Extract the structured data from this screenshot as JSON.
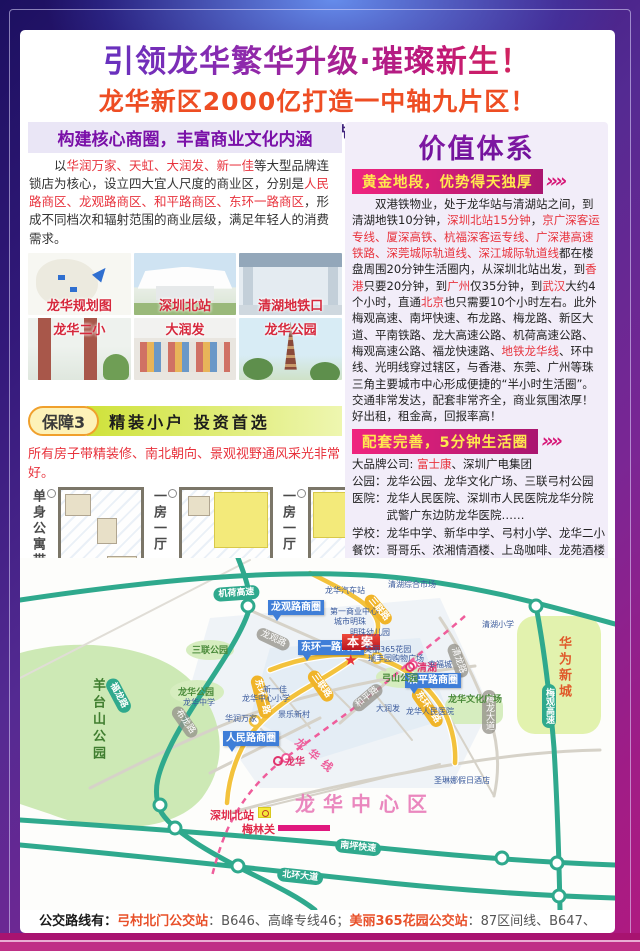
{
  "header": {
    "title": "引领龙华繁华升级·璀璨新生！",
    "subtitle": "龙华新区2000亿打造一中轴九片区！",
    "tagline": "10分钟地铁口醇熟区域、先买先收益、掌控财富人生！"
  },
  "left": {
    "section_title": "构建核心商圈，丰富商业文化内涵",
    "intro_runs": [
      {
        "t": "以",
        "c": ""
      },
      {
        "t": "华润万家、天虹、大润发、新一佳",
        "c": "red"
      },
      {
        "t": "等大型品牌连锁店为核心，设立四大宜人尺度的商业区，分别是",
        "c": ""
      },
      {
        "t": "人民路商区、龙观路商区、和平路商区、东环一路商区",
        "c": "red"
      },
      {
        "t": "，形成不同档次和辐射范围的商业层级，满足年轻人的消费需求。",
        "c": ""
      }
    ],
    "photos": [
      {
        "label": "龙华规划图"
      },
      {
        "label": "深圳北站"
      },
      {
        "label": "清湖地铁口"
      },
      {
        "label": "龙华二小"
      },
      {
        "label": "大润发"
      },
      {
        "label": "龙华公园"
      }
    ],
    "guarantee_badge": "保障3",
    "guarantee_title": "精装小户 投资首选",
    "guarantee_note": "所有房子带精装修、南北朝向、景观视野通风采光非常好。",
    "plans": [
      {
        "label": "单身公寓带精装修"
      },
      {
        "label": "一房一厅"
      },
      {
        "label": "一房一厅"
      }
    ]
  },
  "right": {
    "main_title": "价值体系",
    "chevrons": "»»",
    "banner1": "黄金地段，优势得天独厚",
    "para1_runs": [
      {
        "t": "双港铁物业，处于龙华站与清湖站之间，到清湖地铁10分钟，",
        "c": ""
      },
      {
        "t": "深圳北站15分钟",
        "c": "red"
      },
      {
        "t": "，",
        "c": ""
      },
      {
        "t": "京广深客运专线、厦深高铁、杭福深客运专线、广深港高速铁路、深莞城际轨道线、深江城际轨道线",
        "c": "red"
      },
      {
        "t": "都在楼盘周围20分钟生活圈内，从深圳北站出发，到",
        "c": ""
      },
      {
        "t": "香港",
        "c": "red"
      },
      {
        "t": "只要20分钟，到",
        "c": ""
      },
      {
        "t": "广州",
        "c": "red"
      },
      {
        "t": "仅35分钟，到",
        "c": ""
      },
      {
        "t": "武汉",
        "c": "red"
      },
      {
        "t": "大约4个小时，直通",
        "c": ""
      },
      {
        "t": "北京",
        "c": "red"
      },
      {
        "t": "也只需要10个小时左右。此外梅观高速、南坪快速、布龙路、梅龙路、新区大道、平南铁路、龙大高速公路、机荷高速公路、梅观高速公路、福龙快速路、",
        "c": ""
      },
      {
        "t": "地铁龙华线",
        "c": "red"
      },
      {
        "t": "、环中线、光明线穿过辖区，与香港、东莞、广州等珠三角主要城市中心形成便捷的“半小时生活圈”。交通非常发达，配套非常齐全，商业氛围浓厚！好出租，租金高，回报率高！",
        "c": ""
      }
    ],
    "banner2": "配套完善，5分钟生活圈",
    "fac_company_label": "大品牌公司: ",
    "fac_company_red": "富士康",
    "fac_company_rest": "、深圳广电集团",
    "fac_lines": [
      "公园：龙华公园、龙华文化广场、三联弓村公园",
      "医院：龙华人民医院、深圳市人民医院龙华分院",
      "　　　武警广东边防龙华医院……",
      "学校：龙华中学、新华中学、弓村小学、龙华二小",
      "餐饮：哥哥乐、浓湘情酒楼、上岛咖啡、龙苑酒楼",
      "购物：大润发、华润万家、佳华商场、新一佳商场",
      "酒店：圣琳娜假日酒店、轩莱斯酒店、新宝城酒店",
      "银行：四大银行,平安银行、中信银行、东亚银行"
    ],
    "banner3": "靠山天然氧吧·风水宝地",
    "para3_runs": [
      {
        "t": "项目地处龙华新区旧改第一村(弓村)，青山近城，紧邻占地4万平方米的",
        "c": ""
      },
      {
        "t": "原生态弓山公园，在风水学上形成“明堂之地”",
        "c": "red"
      },
      {
        "t": "，有着百年历史的弓山公园，孕育了多种珍贵树种以及鸟类、昆虫等生物，",
        "c": ""
      },
      {
        "t": "是原生态、纯天然的氧吧。",
        "c": "red"
      }
    ]
  },
  "map": {
    "labels": [
      {
        "t": "机荷高速",
        "x": 193,
        "y": 30,
        "c": "pill-teal",
        "r": -4
      },
      {
        "t": "福龙路",
        "x": 96,
        "y": 118,
        "c": "pill-teal",
        "r": 62
      },
      {
        "t": "梅观高速",
        "x": 522,
        "y": 126,
        "c": "pill-teal vert"
      },
      {
        "t": "南坪快速",
        "x": 316,
        "y": 280,
        "c": "pill-teal",
        "r": 6
      },
      {
        "t": "北环大道",
        "x": 258,
        "y": 309,
        "c": "pill-teal",
        "r": 6
      },
      {
        "t": "三联路",
        "x": 352,
        "y": 34,
        "c": "pill-yellow",
        "r": 50
      },
      {
        "t": "三联路",
        "x": 296,
        "y": 110,
        "c": "pill-yellow",
        "r": 55
      },
      {
        "t": "东环一路",
        "x": 242,
        "y": 116,
        "c": "pill-yellow",
        "r": 75
      },
      {
        "t": "东环一路",
        "x": 400,
        "y": 128,
        "c": "pill-yellow",
        "r": 55
      },
      {
        "t": "龙观路",
        "x": 240,
        "y": 68,
        "c": "pill-gray",
        "r": 25
      },
      {
        "t": "和平路",
        "x": 330,
        "y": 146,
        "c": "pill-gray",
        "r": -40
      },
      {
        "t": "清龙路",
        "x": 438,
        "y": 84,
        "c": "pill-gray",
        "r": 70
      },
      {
        "t": "梅龙大道",
        "x": 462,
        "y": 132,
        "c": "pill-gray vert"
      },
      {
        "t": "布龙路",
        "x": 160,
        "y": 146,
        "c": "pill-gray",
        "r": 55
      },
      {
        "t": "龙观路商圈",
        "x": 248,
        "y": 42,
        "c": "callout"
      },
      {
        "t": "东环一路商圈",
        "x": 278,
        "y": 82,
        "c": "callout"
      },
      {
        "t": "和平路商圈",
        "x": 385,
        "y": 115,
        "c": "callout"
      },
      {
        "t": "人民路商圈",
        "x": 203,
        "y": 173,
        "c": "callout"
      },
      {
        "t": "本案",
        "x": 322,
        "y": 76,
        "c": "benan"
      },
      {
        "t": "★",
        "x": 324,
        "y": 93,
        "c": "star"
      },
      {
        "t": "龙华中心区",
        "x": 275,
        "y": 230,
        "c": "lbl-pink-big"
      },
      {
        "t": "羊台山公园",
        "x": 68,
        "y": 120,
        "c": "lbl-green-vert"
      },
      {
        "t": "华为新城",
        "x": 534,
        "y": 78,
        "c": "lbl-red-vert"
      },
      {
        "t": "三联公园",
        "x": 172,
        "y": 85,
        "c": "lbl-green"
      },
      {
        "t": "弓山公园",
        "x": 362,
        "y": 113,
        "c": "lbl-green"
      },
      {
        "t": "龙华公园",
        "x": 158,
        "y": 127,
        "c": "lbl-green"
      },
      {
        "t": "龙华文化广场",
        "x": 428,
        "y": 134,
        "c": "lbl-green"
      },
      {
        "t": "清湖",
        "x": 385,
        "y": 101,
        "c": "lbl-red-sta"
      },
      {
        "t": "龙华",
        "x": 253,
        "y": 195,
        "c": "lbl-red-sta"
      },
      {
        "t": "龙华线",
        "x": 282,
        "y": 176,
        "c": "lbl-pinkline",
        "r": 40
      },
      {
        "t": "深圳北站",
        "x": 190,
        "y": 249,
        "c": "lbl-red-plain"
      },
      {
        "t": "梅林关",
        "x": 222,
        "y": 263,
        "c": "lbl-red-plain"
      },
      {
        "t": "龙华汽车站",
        "x": 305,
        "y": 27,
        "c": "lbl-small"
      },
      {
        "t": "清湖综合市场",
        "x": 368,
        "y": 21,
        "c": "lbl-small"
      },
      {
        "t": "第一商业中心",
        "x": 310,
        "y": 48,
        "c": "lbl-small"
      },
      {
        "t": "城市明珠",
        "x": 314,
        "y": 58,
        "c": "lbl-small"
      },
      {
        "t": "清湖小学",
        "x": 462,
        "y": 61,
        "c": "lbl-small"
      },
      {
        "t": "明珠幼儿园",
        "x": 330,
        "y": 69,
        "c": "lbl-small"
      },
      {
        "t": "美丽365花园",
        "x": 344,
        "y": 86,
        "c": "lbl-small"
      },
      {
        "t": "瑞丰园购物广场",
        "x": 348,
        "y": 95,
        "c": "lbl-small"
      },
      {
        "t": "幸福城",
        "x": 408,
        "y": 101,
        "c": "lbl-small"
      },
      {
        "t": "龙华中心小学",
        "x": 222,
        "y": 135,
        "c": "lbl-small"
      },
      {
        "t": "新一佳",
        "x": 243,
        "y": 126,
        "c": "lbl-small"
      },
      {
        "t": "华润万家",
        "x": 205,
        "y": 155,
        "c": "lbl-small"
      },
      {
        "t": "景乐新村",
        "x": 258,
        "y": 151,
        "c": "lbl-small"
      },
      {
        "t": "大润发",
        "x": 356,
        "y": 145,
        "c": "lbl-small"
      },
      {
        "t": "龙华人民医院",
        "x": 386,
        "y": 148,
        "c": "lbl-small"
      },
      {
        "t": "龙华中学",
        "x": 163,
        "y": 139,
        "c": "lbl-small"
      },
      {
        "t": "圣琳娜假日酒店",
        "x": 414,
        "y": 217,
        "c": "lbl-small"
      }
    ]
  },
  "footer": {
    "runs": [
      {
        "t": "公交路线有：",
        "c": "fb"
      },
      {
        "t": "弓村北门公交站",
        "c": "fo"
      },
      {
        "t": "：B646、高峰专线46；",
        "c": ""
      },
      {
        "t": "美丽365花园公交站",
        "c": "fo"
      },
      {
        "t": "：87区间线、B647、B792、E1、M212、M225、M353、M408、M401、M393、深莞2线、302、M242。",
        "c": ""
      }
    ]
  }
}
